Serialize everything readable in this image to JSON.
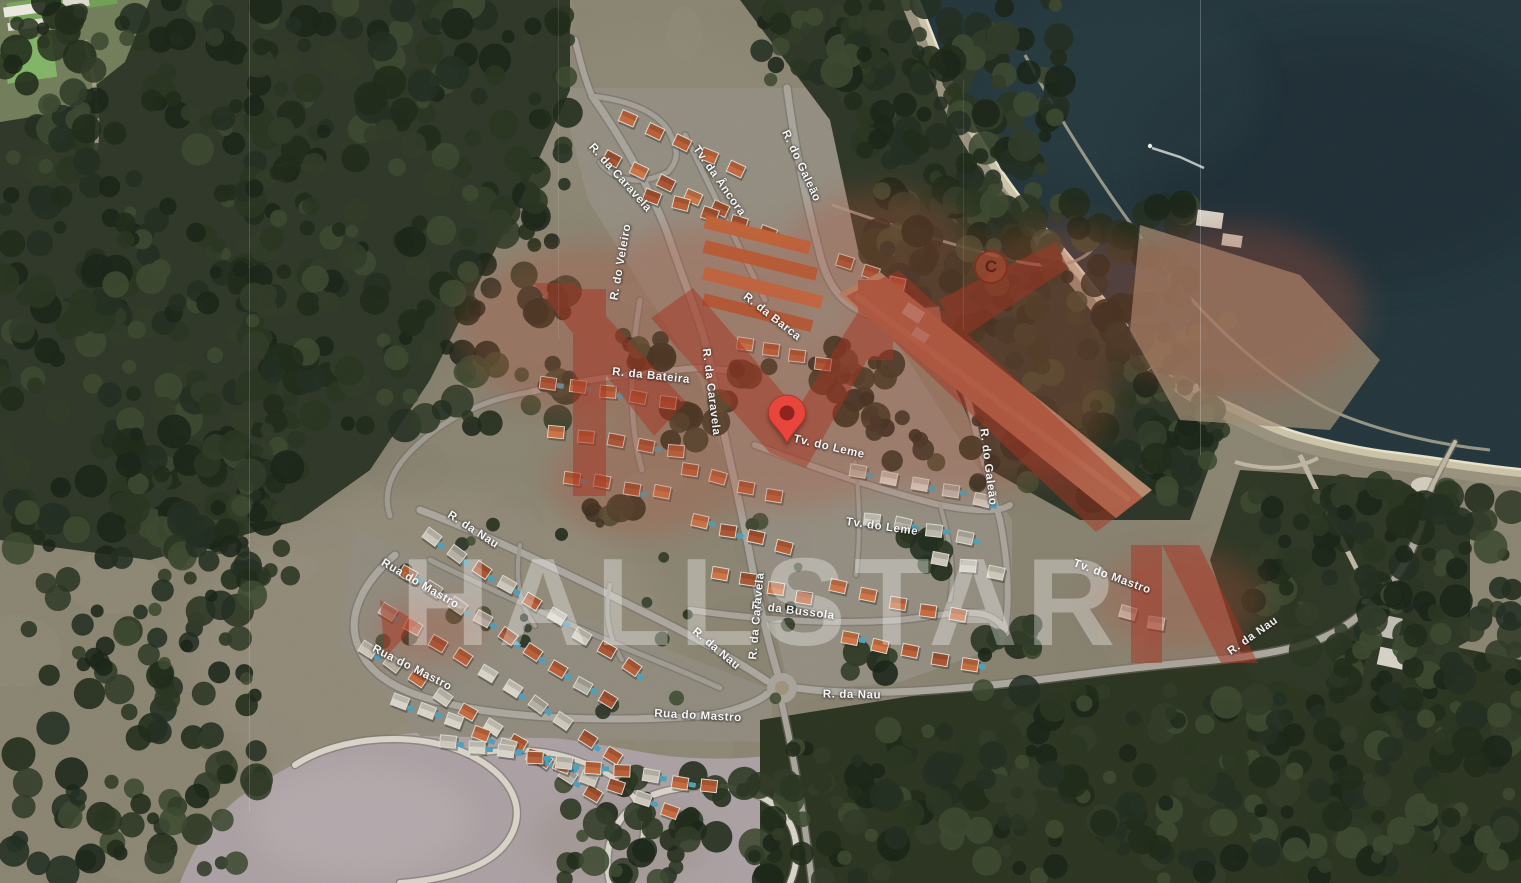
{
  "map": {
    "title": "Satellite map of coastal residential development",
    "watermark_text": "HALLSTAR",
    "watermark_color": "rgba(255,255,255,0.32)",
    "logo_color": "#a33120",
    "copyright_glyph": "C",
    "pin": {
      "x": 787,
      "y": 442,
      "color": "#e8453c",
      "inner_color": "#8e241d"
    },
    "street_labels": [
      {
        "text": "R. da Caravela",
        "x": 620,
        "y": 178,
        "r": 48
      },
      {
        "text": "Tv. da Âncora",
        "x": 719,
        "y": 181,
        "r": 55
      },
      {
        "text": "R. do Galeão",
        "x": 801,
        "y": 166,
        "r": 65
      },
      {
        "text": "R. do Veleiro",
        "x": 621,
        "y": 262,
        "r": -80
      },
      {
        "text": "R. da Caravela",
        "x": 711,
        "y": 392,
        "r": 83
      },
      {
        "text": "R. da Bateira",
        "x": 651,
        "y": 376,
        "r": 6
      },
      {
        "text": "R. da Barca",
        "x": 772,
        "y": 317,
        "r": 38
      },
      {
        "text": "Tv. do Leme",
        "x": 829,
        "y": 447,
        "r": 13
      },
      {
        "text": "Tv. do Leme",
        "x": 882,
        "y": 527,
        "r": 8
      },
      {
        "text": "R. do Galeão",
        "x": 988,
        "y": 467,
        "r": 83
      },
      {
        "text": "R. da Bussola",
        "x": 793,
        "y": 611,
        "r": 7
      },
      {
        "text": "Tv. do Mastro",
        "x": 1112,
        "y": 577,
        "r": 20
      },
      {
        "text": "R. da Nau",
        "x": 473,
        "y": 530,
        "r": 33
      },
      {
        "text": "Rua do Mastro",
        "x": 420,
        "y": 584,
        "r": 30
      },
      {
        "text": "Rua do Mastro",
        "x": 412,
        "y": 668,
        "r": 27
      },
      {
        "text": "R. da Nau",
        "x": 716,
        "y": 649,
        "r": 40
      },
      {
        "text": "Rua do Mastro",
        "x": 698,
        "y": 716,
        "r": 3
      },
      {
        "text": "R. da Nau",
        "x": 852,
        "y": 695,
        "r": 1
      },
      {
        "text": "R. da Caravela",
        "x": 757,
        "y": 616,
        "r": -85
      },
      {
        "text": "R. da Nau",
        "x": 1253,
        "y": 636,
        "r": -35
      }
    ]
  }
}
